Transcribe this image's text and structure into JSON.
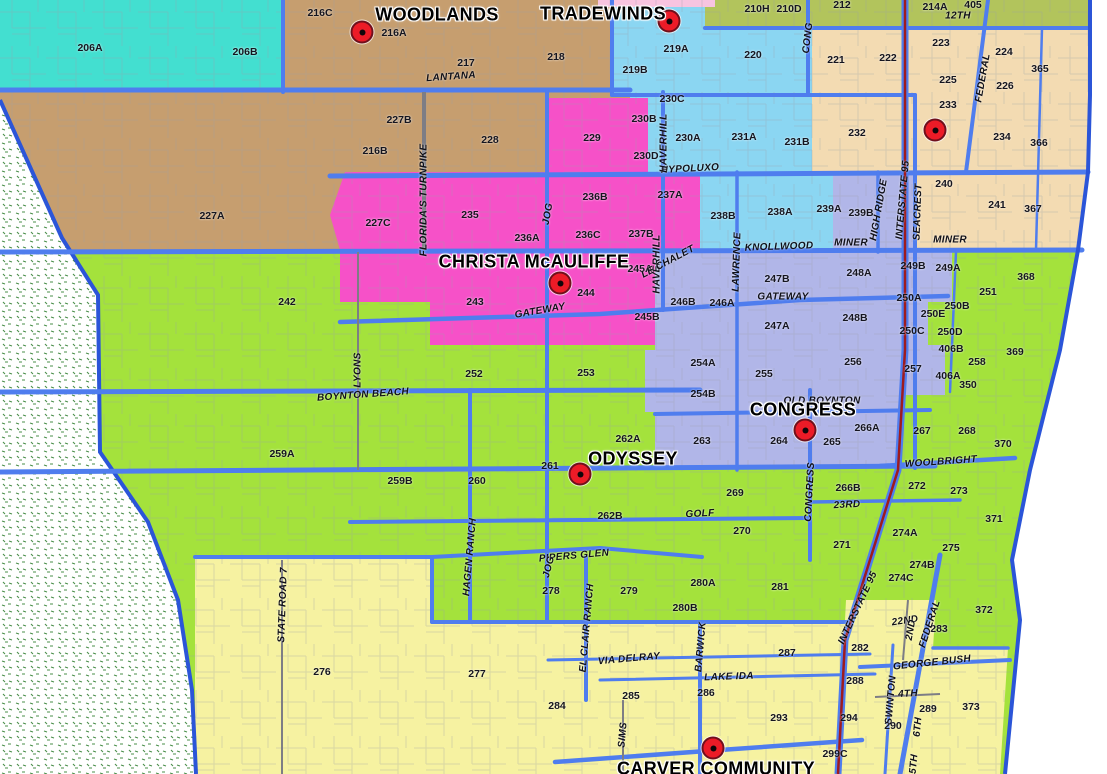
{
  "map_title": "Elementary school boundary map",
  "palette": {
    "teal": "#43DFD0",
    "tan": "#C69E6F",
    "olive": "#B2C45C",
    "cyan": "#8BD6F2",
    "peach": "#F3DBB2",
    "pink": "#F651C8",
    "lightpink": "#F8C4E0",
    "lavender": "#B1B6E8",
    "green": "#A4E23C",
    "yellow": "#F6F2A1",
    "road_blue": "#4F7DEE",
    "road_minor": "#9BA0A8",
    "interstate_red": "#9E1B1E",
    "school_dot": "#EC1B27",
    "stipple_green": "#4A8F4A",
    "border_blue": "#2B55D8"
  },
  "schools": [
    {
      "t": "WOODLANDS",
      "lx": 437,
      "ly": 15,
      "dx": 362,
      "dy": 32
    },
    {
      "t": "TRADEWINDS",
      "lx": 603,
      "ly": 14,
      "dx": 669,
      "dy": 21
    },
    {
      "t": "CHRISTA McAULIFFE",
      "lx": 534,
      "ly": 262,
      "dx": 560,
      "dy": 283
    },
    {
      "t": "CONGRESS",
      "lx": 803,
      "ly": 410,
      "dx": 805,
      "dy": 430
    },
    {
      "t": "ODYSSEY",
      "lx": 633,
      "ly": 459,
      "dx": 580,
      "dy": 474
    },
    {
      "t": "CARVER COMMUNITY",
      "lx": 716,
      "ly": 769,
      "dx": 713,
      "dy": 748
    },
    {
      "t": "",
      "lx": null,
      "ly": null,
      "dx": 935,
      "dy": 130
    }
  ],
  "zones": [
    {
      "t": "206A",
      "x": 90,
      "y": 48
    },
    {
      "t": "206B",
      "x": 245,
      "y": 52
    },
    {
      "t": "216C",
      "x": 320,
      "y": 13
    },
    {
      "t": "216A",
      "x": 394,
      "y": 33
    },
    {
      "t": "217",
      "x": 466,
      "y": 63
    },
    {
      "t": "218",
      "x": 556,
      "y": 57
    },
    {
      "t": "219B",
      "x": 635,
      "y": 70
    },
    {
      "t": "219A",
      "x": 676,
      "y": 49
    },
    {
      "t": "220",
      "x": 753,
      "y": 55
    },
    {
      "t": "210H",
      "x": 757,
      "y": 9
    },
    {
      "t": "210D",
      "x": 789,
      "y": 9
    },
    {
      "t": "212",
      "x": 842,
      "y": 5
    },
    {
      "t": "214A",
      "x": 935,
      "y": 7
    },
    {
      "t": "405",
      "x": 973,
      "y": 5
    },
    {
      "t": "221",
      "x": 836,
      "y": 60
    },
    {
      "t": "222",
      "x": 888,
      "y": 58
    },
    {
      "t": "223",
      "x": 941,
      "y": 43
    },
    {
      "t": "224",
      "x": 1004,
      "y": 52
    },
    {
      "t": "225",
      "x": 948,
      "y": 80
    },
    {
      "t": "226",
      "x": 1005,
      "y": 86
    },
    {
      "t": "233",
      "x": 948,
      "y": 105
    },
    {
      "t": "234",
      "x": 1002,
      "y": 137
    },
    {
      "t": "365",
      "x": 1040,
      "y": 69
    },
    {
      "t": "366",
      "x": 1039,
      "y": 143
    },
    {
      "t": "227B",
      "x": 399,
      "y": 120
    },
    {
      "t": "228",
      "x": 490,
      "y": 140
    },
    {
      "t": "216B",
      "x": 375,
      "y": 151
    },
    {
      "t": "229",
      "x": 592,
      "y": 138
    },
    {
      "t": "230C",
      "x": 672,
      "y": 99
    },
    {
      "t": "230B",
      "x": 644,
      "y": 119
    },
    {
      "t": "230A",
      "x": 688,
      "y": 138
    },
    {
      "t": "231A",
      "x": 744,
      "y": 137
    },
    {
      "t": "230D",
      "x": 646,
      "y": 156
    },
    {
      "t": "231B",
      "x": 797,
      "y": 142
    },
    {
      "t": "232",
      "x": 857,
      "y": 133
    },
    {
      "t": "227A",
      "x": 212,
      "y": 216
    },
    {
      "t": "227C",
      "x": 378,
      "y": 223
    },
    {
      "t": "235",
      "x": 470,
      "y": 215
    },
    {
      "t": "236A",
      "x": 527,
      "y": 238
    },
    {
      "t": "236B",
      "x": 595,
      "y": 197
    },
    {
      "t": "236C",
      "x": 588,
      "y": 235
    },
    {
      "t": "237A",
      "x": 670,
      "y": 195
    },
    {
      "t": "237B",
      "x": 641,
      "y": 234
    },
    {
      "t": "238B",
      "x": 723,
      "y": 216
    },
    {
      "t": "238A",
      "x": 780,
      "y": 212
    },
    {
      "t": "239A",
      "x": 829,
      "y": 209
    },
    {
      "t": "239B",
      "x": 861,
      "y": 213
    },
    {
      "t": "240",
      "x": 944,
      "y": 184
    },
    {
      "t": "241",
      "x": 997,
      "y": 205
    },
    {
      "t": "367",
      "x": 1033,
      "y": 209
    },
    {
      "t": "242",
      "x": 287,
      "y": 302
    },
    {
      "t": "243",
      "x": 475,
      "y": 302
    },
    {
      "t": "244",
      "x": 586,
      "y": 293
    },
    {
      "t": "245A",
      "x": 640,
      "y": 269
    },
    {
      "t": "245B",
      "x": 647,
      "y": 317
    },
    {
      "t": "246B",
      "x": 683,
      "y": 302
    },
    {
      "t": "246A",
      "x": 722,
      "y": 303
    },
    {
      "t": "247B",
      "x": 777,
      "y": 279
    },
    {
      "t": "247A",
      "x": 777,
      "y": 326
    },
    {
      "t": "248A",
      "x": 859,
      "y": 273
    },
    {
      "t": "248B",
      "x": 855,
      "y": 318
    },
    {
      "t": "249B",
      "x": 913,
      "y": 266
    },
    {
      "t": "249A",
      "x": 948,
      "y": 268
    },
    {
      "t": "250A",
      "x": 909,
      "y": 298
    },
    {
      "t": "250B",
      "x": 957,
      "y": 306
    },
    {
      "t": "250E",
      "x": 933,
      "y": 314
    },
    {
      "t": "250C",
      "x": 912,
      "y": 331
    },
    {
      "t": "250D",
      "x": 950,
      "y": 332
    },
    {
      "t": "251",
      "x": 988,
      "y": 292
    },
    {
      "t": "368",
      "x": 1026,
      "y": 277
    },
    {
      "t": "406B",
      "x": 951,
      "y": 349
    },
    {
      "t": "258",
      "x": 977,
      "y": 362
    },
    {
      "t": "406A",
      "x": 948,
      "y": 376
    },
    {
      "t": "350",
      "x": 968,
      "y": 385
    },
    {
      "t": "369",
      "x": 1015,
      "y": 352
    },
    {
      "t": "252",
      "x": 474,
      "y": 374
    },
    {
      "t": "253",
      "x": 586,
      "y": 373
    },
    {
      "t": "254A",
      "x": 703,
      "y": 363
    },
    {
      "t": "255",
      "x": 764,
      "y": 374
    },
    {
      "t": "256",
      "x": 853,
      "y": 362
    },
    {
      "t": "257",
      "x": 913,
      "y": 369
    },
    {
      "t": "254B",
      "x": 703,
      "y": 394
    },
    {
      "t": "259A",
      "x": 282,
      "y": 454
    },
    {
      "t": "259B",
      "x": 400,
      "y": 481
    },
    {
      "t": "260",
      "x": 477,
      "y": 481
    },
    {
      "t": "261",
      "x": 550,
      "y": 466
    },
    {
      "t": "262A",
      "x": 628,
      "y": 439
    },
    {
      "t": "263",
      "x": 702,
      "y": 441
    },
    {
      "t": "264",
      "x": 779,
      "y": 441
    },
    {
      "t": "265",
      "x": 832,
      "y": 442
    },
    {
      "t": "266A",
      "x": 867,
      "y": 428
    },
    {
      "t": "267",
      "x": 922,
      "y": 431
    },
    {
      "t": "268",
      "x": 967,
      "y": 431
    },
    {
      "t": "370",
      "x": 1003,
      "y": 444
    },
    {
      "t": "262B",
      "x": 610,
      "y": 516
    },
    {
      "t": "269",
      "x": 735,
      "y": 493
    },
    {
      "t": "270",
      "x": 742,
      "y": 531
    },
    {
      "t": "271",
      "x": 842,
      "y": 545
    },
    {
      "t": "266B",
      "x": 848,
      "y": 488
    },
    {
      "t": "272",
      "x": 917,
      "y": 486
    },
    {
      "t": "273",
      "x": 959,
      "y": 491
    },
    {
      "t": "371",
      "x": 994,
      "y": 519
    },
    {
      "t": "278",
      "x": 551,
      "y": 591
    },
    {
      "t": "279",
      "x": 629,
      "y": 591
    },
    {
      "t": "280A",
      "x": 703,
      "y": 583
    },
    {
      "t": "280B",
      "x": 685,
      "y": 608
    },
    {
      "t": "281",
      "x": 780,
      "y": 587
    },
    {
      "t": "274A",
      "x": 905,
      "y": 533
    },
    {
      "t": "275",
      "x": 951,
      "y": 548
    },
    {
      "t": "274B",
      "x": 922,
      "y": 565
    },
    {
      "t": "274C",
      "x": 901,
      "y": 578
    },
    {
      "t": "276",
      "x": 322,
      "y": 672
    },
    {
      "t": "277",
      "x": 477,
      "y": 674
    },
    {
      "t": "283",
      "x": 939,
      "y": 629
    },
    {
      "t": "372",
      "x": 984,
      "y": 610
    },
    {
      "t": "282",
      "x": 860,
      "y": 648
    },
    {
      "t": "288",
      "x": 855,
      "y": 681
    },
    {
      "t": "287",
      "x": 787,
      "y": 653
    },
    {
      "t": "284",
      "x": 557,
      "y": 706
    },
    {
      "t": "285",
      "x": 631,
      "y": 696
    },
    {
      "t": "286",
      "x": 706,
      "y": 693
    },
    {
      "t": "293",
      "x": 779,
      "y": 718
    },
    {
      "t": "294",
      "x": 849,
      "y": 718
    },
    {
      "t": "290",
      "x": 893,
      "y": 726
    },
    {
      "t": "289",
      "x": 928,
      "y": 709
    },
    {
      "t": "373",
      "x": 971,
      "y": 707
    },
    {
      "t": "299C",
      "x": 835,
      "y": 754
    }
  ],
  "roads": [
    {
      "t": "LANTANA",
      "x": 451,
      "y": 77,
      "r": -4
    },
    {
      "t": "12TH",
      "x": 958,
      "y": 16,
      "r": 0
    },
    {
      "t": "CONG",
      "x": 808,
      "y": 38,
      "r": -83
    },
    {
      "t": "FEDERAL",
      "x": 983,
      "y": 78,
      "r": -80
    },
    {
      "t": "HYPOLUXO",
      "x": 690,
      "y": 169,
      "r": -3
    },
    {
      "t": "FLORIDA'S TURNPIKE",
      "x": 424,
      "y": 200,
      "r": -90
    },
    {
      "t": "HAVERHILL",
      "x": 664,
      "y": 143,
      "r": -90
    },
    {
      "t": "HAVERHILL",
      "x": 657,
      "y": 264,
      "r": -90
    },
    {
      "t": "INTERSTATE 95",
      "x": 903,
      "y": 200,
      "r": -85
    },
    {
      "t": "SEACREST",
      "x": 918,
      "y": 212,
      "r": -88
    },
    {
      "t": "HIGH RIDGE",
      "x": 879,
      "y": 210,
      "r": -80
    },
    {
      "t": "MINER",
      "x": 851,
      "y": 243,
      "r": 0
    },
    {
      "t": "MINER",
      "x": 950,
      "y": 240,
      "r": 0
    },
    {
      "t": "KNOLLWOOD",
      "x": 779,
      "y": 247,
      "r": -2
    },
    {
      "t": "LAWRENCE",
      "x": 737,
      "y": 262,
      "r": -88
    },
    {
      "t": "LE CHALET",
      "x": 668,
      "y": 262,
      "r": -28
    },
    {
      "t": "JOG",
      "x": 548,
      "y": 214,
      "r": -80
    },
    {
      "t": "GATEWAY",
      "x": 540,
      "y": 311,
      "r": -10
    },
    {
      "t": "GATEWAY",
      "x": 783,
      "y": 297,
      "r": 0
    },
    {
      "t": "LYONS",
      "x": 358,
      "y": 370,
      "r": -90
    },
    {
      "t": "BOYNTON BEACH",
      "x": 363,
      "y": 395,
      "r": -4
    },
    {
      "t": "OLD BOYNTON",
      "x": 822,
      "y": 401,
      "r": 0
    },
    {
      "t": "CONGRESS",
      "x": 810,
      "y": 492,
      "r": -87
    },
    {
      "t": "23RD",
      "x": 847,
      "y": 505,
      "r": -3
    },
    {
      "t": "GOLF",
      "x": 700,
      "y": 514,
      "r": -3
    },
    {
      "t": "WOOLBRIGHT",
      "x": 941,
      "y": 462,
      "r": -4
    },
    {
      "t": "PIPERS GLEN",
      "x": 574,
      "y": 556,
      "r": -5
    },
    {
      "t": "HAGEN RANCH",
      "x": 470,
      "y": 557,
      "r": -85
    },
    {
      "t": "STATE ROAD 7",
      "x": 283,
      "y": 605,
      "r": -88
    },
    {
      "t": "JOG",
      "x": 549,
      "y": 567,
      "r": -75
    },
    {
      "t": "EL CLAIR RANCH",
      "x": 587,
      "y": 628,
      "r": -85
    },
    {
      "t": "VIA DELRAY",
      "x": 629,
      "y": 659,
      "r": -5
    },
    {
      "t": "BARWICK",
      "x": 701,
      "y": 647,
      "r": -85
    },
    {
      "t": "LAKE IDA",
      "x": 729,
      "y": 677,
      "r": -2
    },
    {
      "t": "SIMS",
      "x": 623,
      "y": 735,
      "r": -85
    },
    {
      "t": "INTERSTATE 95",
      "x": 858,
      "y": 608,
      "r": -65
    },
    {
      "t": "22ND",
      "x": 905,
      "y": 621,
      "r": -8
    },
    {
      "t": "FEDERAL",
      "x": 930,
      "y": 624,
      "r": -72
    },
    {
      "t": "2ND",
      "x": 911,
      "y": 630,
      "r": -80
    },
    {
      "t": "GEORGE BUSH",
      "x": 932,
      "y": 663,
      "r": -6
    },
    {
      "t": "SWINTON",
      "x": 891,
      "y": 700,
      "r": -85
    },
    {
      "t": "4TH",
      "x": 908,
      "y": 694,
      "r": -3
    },
    {
      "t": "6TH",
      "x": 918,
      "y": 727,
      "r": -85
    },
    {
      "t": "5TH",
      "x": 914,
      "y": 764,
      "r": -85
    }
  ]
}
